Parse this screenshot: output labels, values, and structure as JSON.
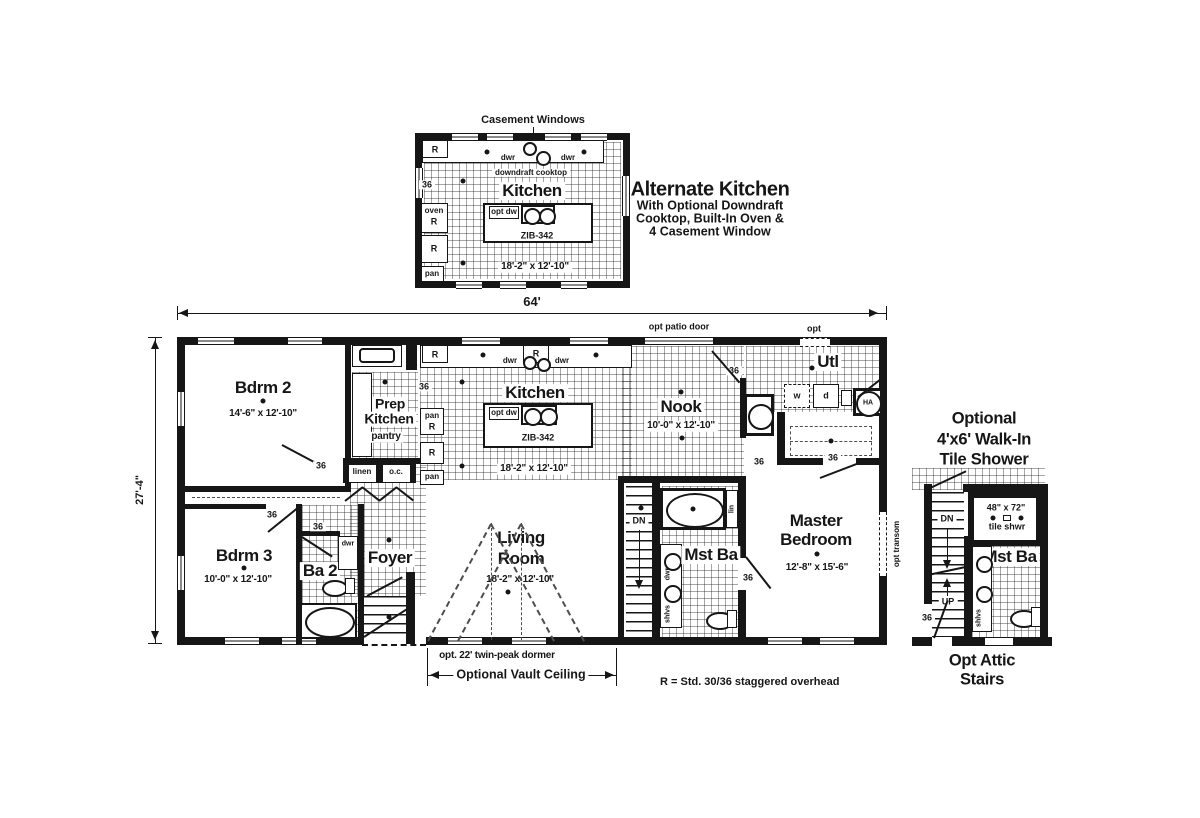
{
  "alt": {
    "casement": "Casement Windows",
    "name": "Kitchen",
    "downdraft": "downdraft cooktop",
    "optdw": "opt dw",
    "model": "ZIB-342",
    "size": "18'-2\" x 12'-10\"",
    "oven": "oven",
    "note_title": "Alternate Kitchen",
    "note1": "With Optional Downdraft",
    "note2": "Cooktop, Built-In Oven &",
    "note3": "4 Casement Window"
  },
  "g": {
    "r": "R",
    "pan": "pan",
    "dwr": "dwr",
    "n36": "36",
    "w": "w",
    "d": "d",
    "ha": "HA",
    "dn": "DN",
    "up": "UP",
    "lin": "lin",
    "linen": "linen",
    "oc": "o.c.",
    "shlvs": "shlvs",
    "opt_transom": "opt transom"
  },
  "dim": {
    "width": "64'",
    "depth": "27'-4\""
  },
  "ann": {
    "patio": "opt patio door",
    "opt": "opt",
    "dormer": "opt. 22' twin-peak dormer",
    "vault": "Optional Vault Ceiling",
    "rnote": "R = Std. 30/36 staggered overhead"
  },
  "rooms": {
    "bdrm2_name": "Bdrm 2",
    "bdrm2_size": "14'-6\" x 12'-10\"",
    "prep1": "Prep",
    "prep2": "Kitchen",
    "pantry": "pantry",
    "kitchen_name": "Kitchen",
    "kitchen_size": "18'-2\" x 12'-10\"",
    "kitchen_model": "ZIB-342",
    "kitchen_optdw": "opt dw",
    "nook_name": "Nook",
    "nook_size": "10'-0\" x 12'-10\"",
    "utl_name": "Utl",
    "master1": "Master",
    "master2": "Bedroom",
    "master_size": "12'-8\" x 15'-6\"",
    "bdrm3_name": "Bdrm 3",
    "bdrm3_size": "10'-0\" x 12'-10\"",
    "ba2_name": "Ba 2",
    "foyer_name": "Foyer",
    "living1": "Living",
    "living2": "Room",
    "living_size": "18'-2\" x 12'-10\"",
    "mstba_name": "Mst Ba"
  },
  "shower": {
    "t1": "Optional",
    "t2": "4'x6' Walk-In",
    "t3": "Tile Shower",
    "size": "48\" x 72\"",
    "label": "tile shwr",
    "mstba": "Mst Ba",
    "c1": "Opt Attic",
    "c2": "Stairs"
  }
}
